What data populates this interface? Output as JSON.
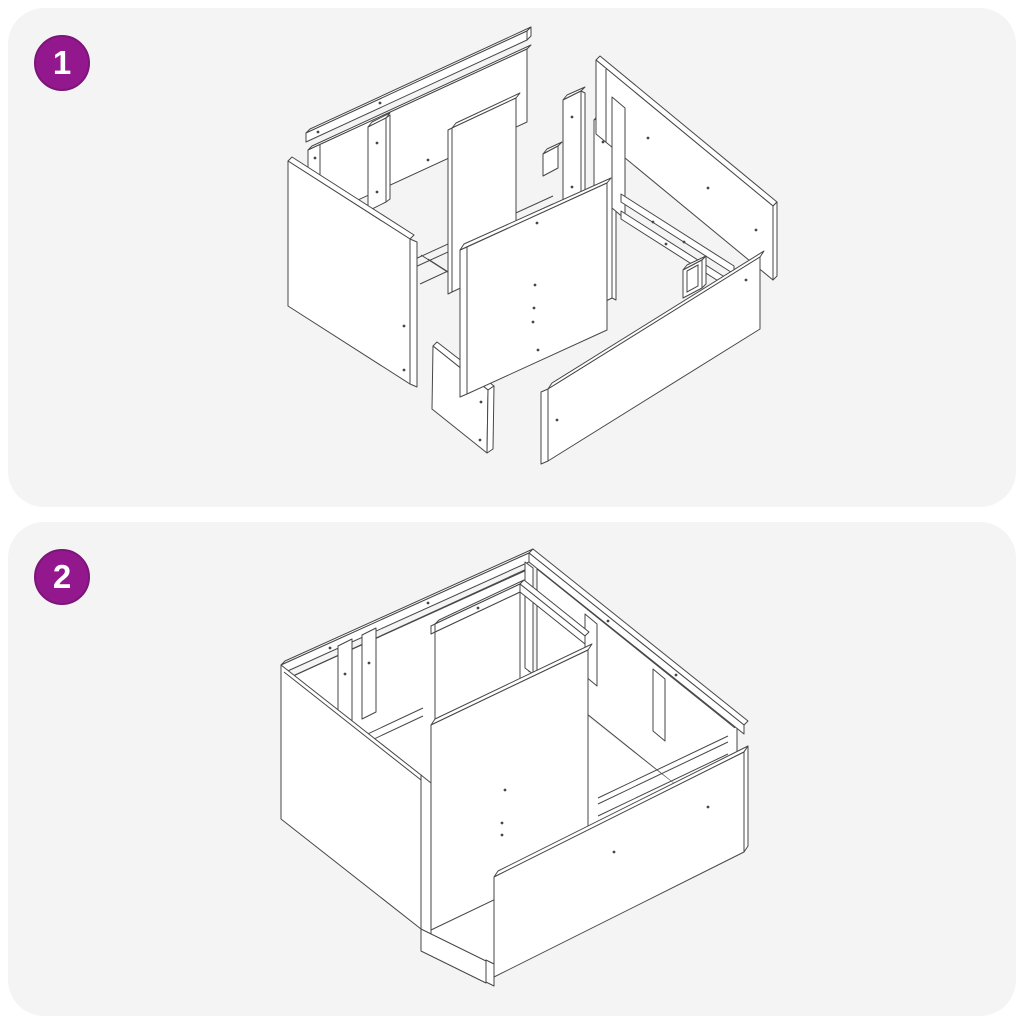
{
  "colors": {
    "page_bg": "#ffffff",
    "panel_bg": "#f4f4f4",
    "line": "#474747",
    "part_fill": "#ffffff",
    "badge_bg": "#93188e",
    "badge_ring": "#7c1578",
    "badge_text": "#ffffff"
  },
  "steps": [
    {
      "number": "1",
      "diagram": "exploded-parts-view"
    },
    {
      "number": "2",
      "diagram": "assembled-frame-view"
    }
  ]
}
